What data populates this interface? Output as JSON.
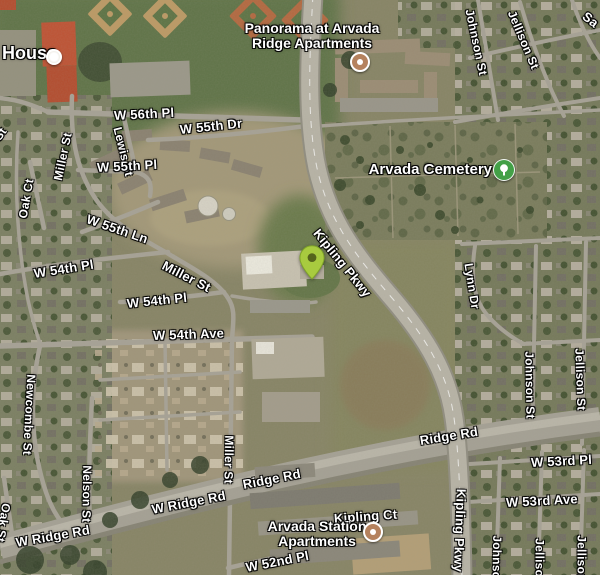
{
  "map": {
    "pois": {
      "house": {
        "label": "House"
      },
      "panorama": {
        "line1": "Panorama at Arvada",
        "line2": "Ridge Apartments"
      },
      "cemetery": {
        "label": "Arvada Cemetery"
      },
      "station": {
        "line1": "Arvada Station",
        "line2": "Apartments"
      }
    },
    "streets": [
      {
        "text": "W 56th Pl"
      },
      {
        "text": "Miller St"
      },
      {
        "text": "Lewis St"
      },
      {
        "text": "W 55th Dr"
      },
      {
        "text": "W 55th Pl"
      },
      {
        "text": "Oak Ct"
      },
      {
        "text": "W 55th Ln"
      },
      {
        "text": "St"
      },
      {
        "text": "W 54th Pl"
      },
      {
        "text": "Miller St"
      },
      {
        "text": "W 54th Pl"
      },
      {
        "text": "W 54th Ave"
      },
      {
        "text": "Newcombe St"
      },
      {
        "text": "Nelson St"
      },
      {
        "text": "Oak St"
      },
      {
        "text": "W Ridge Rd"
      },
      {
        "text": "Miller St"
      },
      {
        "text": "Ridge Rd"
      },
      {
        "text": "W Ridge Rd"
      },
      {
        "text": "Ridge Rd"
      },
      {
        "text": "W 52nd Pl"
      },
      {
        "text": "Kipling Ct"
      },
      {
        "text": "Kipling Pkwy"
      },
      {
        "text": "Kipling Pkwy"
      },
      {
        "text": "Lynn Dr"
      },
      {
        "text": "Johnson St"
      },
      {
        "text": "Jellison St"
      },
      {
        "text": "Sa"
      },
      {
        "text": "Johnson St"
      },
      {
        "text": "Jellison St"
      },
      {
        "text": "W 53rd Pl"
      },
      {
        "text": "W 53rd Ave"
      },
      {
        "text": "Johnson St"
      },
      {
        "text": "Jellison St"
      },
      {
        "text": "Jellison St"
      }
    ],
    "colors": {
      "pin_green": "#a8cb3f",
      "pin_dot": "#55641c",
      "poi_orange": "#b5825e",
      "cemetery_green": "#43a047",
      "label_white": "#ffffff"
    }
  }
}
